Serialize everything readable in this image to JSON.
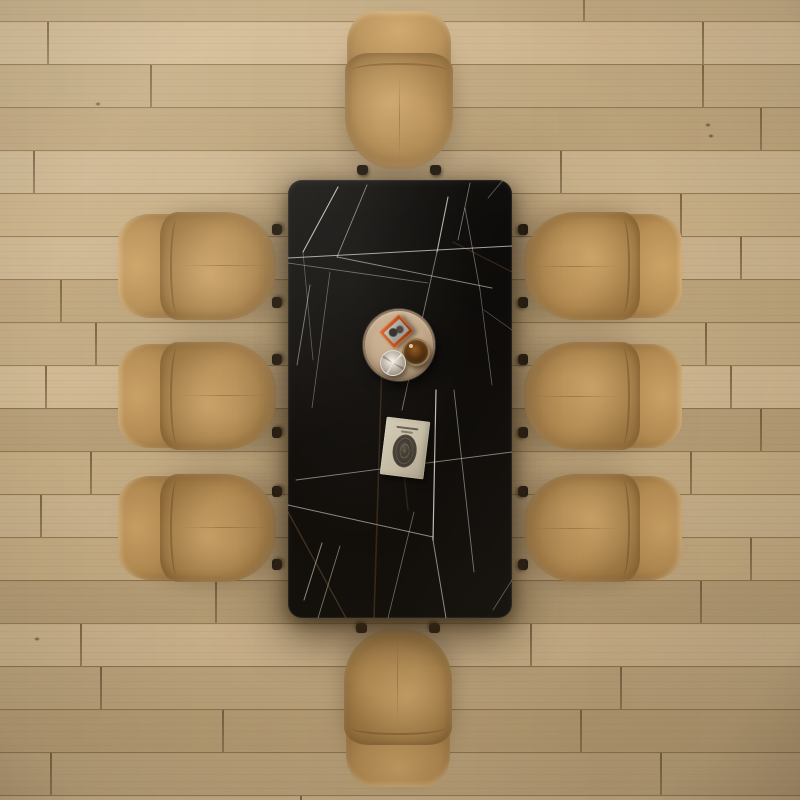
{
  "scene": {
    "colors": {
      "floor_base": "#c7af89",
      "floor_joint": "#6c5434",
      "table_black": "#0d0b09",
      "vein_white": "#e9e5da",
      "vein_gold": "#b98f52",
      "leather": "#b88f55",
      "leather_light": "#cda467",
      "leather_dark": "#96703b",
      "foot": "#221a12",
      "tray": "#c3a98a",
      "tray_rim": "#8a7258",
      "box_orange": "#c4511d",
      "box_gray": "#a4a19a",
      "whiskey": "#33200a",
      "crystal": "#cec8be",
      "book_cover": "#ccc3ad",
      "book_oval": "#38342c"
    },
    "floor": {
      "plank_height": 44,
      "rows": [
        {
          "t": -22,
          "c": 1,
          "j": [
            583
          ]
        },
        {
          "t": 21,
          "c": 0,
          "j": [
            47,
            702
          ]
        },
        {
          "t": 64,
          "c": 1,
          "j": [
            150,
            702
          ]
        },
        {
          "t": 107,
          "c": 2,
          "j": [
            760
          ]
        },
        {
          "t": 150,
          "c": 0,
          "j": [
            33,
            560
          ]
        },
        {
          "t": 193,
          "c": 1,
          "j": [
            680
          ]
        },
        {
          "t": 236,
          "c": 0,
          "j": [
            740
          ]
        },
        {
          "t": 279,
          "c": 2,
          "j": [
            60
          ]
        },
        {
          "t": 322,
          "c": 1,
          "j": [
            95,
            705
          ]
        },
        {
          "t": 365,
          "c": 0,
          "j": [
            45,
            730
          ]
        },
        {
          "t": 408,
          "c": 2,
          "j": [
            760
          ]
        },
        {
          "t": 451,
          "c": 1,
          "j": [
            90,
            690
          ]
        },
        {
          "t": 494,
          "c": 0,
          "j": [
            40
          ]
        },
        {
          "t": 537,
          "c": 1,
          "j": [
            750
          ]
        },
        {
          "t": 580,
          "c": 2,
          "j": [
            215,
            700
          ]
        },
        {
          "t": 623,
          "c": 0,
          "j": [
            80,
            530
          ]
        },
        {
          "t": 666,
          "c": 1,
          "j": [
            100,
            620
          ]
        },
        {
          "t": 709,
          "c": 2,
          "j": [
            222,
            580
          ]
        },
        {
          "t": 752,
          "c": 1,
          "j": [
            50,
            660
          ]
        },
        {
          "t": 795,
          "c": 0,
          "j": [
            300
          ]
        }
      ],
      "knots": [
        [
          705,
          123
        ],
        [
          708,
          134
        ],
        [
          34,
          637
        ],
        [
          420,
          62
        ],
        [
          95,
          102
        ]
      ]
    },
    "table": {
      "x": 288,
      "y": 180,
      "width": 224,
      "height": 438,
      "corner_radius": 14
    },
    "veins": [
      [
        50,
        7,
        15,
        72,
        1.1,
        0.8,
        "w"
      ],
      [
        79,
        5,
        49,
        77,
        0.9,
        0.55,
        "w"
      ],
      [
        15,
        72,
        25,
        180,
        0.8,
        0.35,
        "w"
      ],
      [
        160,
        17,
        149,
        72,
        1.1,
        0.75,
        "w"
      ],
      [
        149,
        72,
        114,
        230,
        0.9,
        0.5,
        "w"
      ],
      [
        182,
        3,
        170,
        60,
        0.8,
        0.5,
        "w"
      ],
      [
        215,
        0,
        200,
        18,
        0.8,
        0.4,
        "w"
      ],
      [
        0,
        78,
        224,
        66,
        1.0,
        0.7,
        "w"
      ],
      [
        0,
        83,
        140,
        103,
        0.8,
        0.45,
        "w"
      ],
      [
        49,
        77,
        204,
        108,
        0.9,
        0.55,
        "w"
      ],
      [
        177,
        28,
        192,
        110,
        0.8,
        0.45,
        "w"
      ],
      [
        192,
        110,
        204,
        205,
        0.8,
        0.4,
        "w"
      ],
      [
        22,
        105,
        9,
        185,
        0.9,
        0.5,
        "w"
      ],
      [
        42,
        92,
        24,
        228,
        0.8,
        0.4,
        "w"
      ],
      [
        148,
        210,
        145,
        360,
        1.2,
        0.85,
        "w"
      ],
      [
        145,
        360,
        158,
        438,
        1.0,
        0.6,
        "w"
      ],
      [
        166,
        210,
        186,
        392,
        0.9,
        0.5,
        "w"
      ],
      [
        0,
        325,
        145,
        357,
        1.0,
        0.6,
        "w"
      ],
      [
        8,
        300,
        224,
        272,
        0.9,
        0.55,
        "w"
      ],
      [
        34,
        363,
        16,
        420,
        1.0,
        0.6,
        "w"
      ],
      [
        52,
        366,
        30,
        438,
        0.9,
        0.5,
        "w"
      ],
      [
        100,
        438,
        126,
        332,
        0.8,
        0.45,
        "w"
      ],
      [
        224,
        150,
        196,
        130,
        0.7,
        0.35,
        "w"
      ],
      [
        205,
        430,
        224,
        400,
        0.8,
        0.4,
        "w"
      ],
      [
        95,
        150,
        86,
        438,
        1.6,
        0.22,
        "g"
      ],
      [
        0,
        332,
        58,
        438,
        1.3,
        0.3,
        "g"
      ],
      [
        224,
        92,
        165,
        62,
        1.2,
        0.22,
        "g"
      ],
      [
        110,
        240,
        120,
        330,
        1.4,
        0.18,
        "g"
      ]
    ],
    "chairs": {
      "count": 8,
      "body_width": 110,
      "body_length": 160,
      "positions": [
        {
          "id": "top",
          "cx": 399,
          "cy": 91,
          "rot": 0
        },
        {
          "id": "bottom",
          "cx": 398,
          "cy": 707,
          "rot": 180
        },
        {
          "id": "left-1",
          "cx": 198,
          "cy": 266,
          "rot": -90
        },
        {
          "id": "left-2",
          "cx": 198,
          "cy": 396,
          "rot": -90
        },
        {
          "id": "left-3",
          "cx": 198,
          "cy": 528,
          "rot": -90
        },
        {
          "id": "right-1",
          "cx": 602,
          "cy": 266,
          "rot": 90
        },
        {
          "id": "right-2",
          "cx": 602,
          "cy": 396,
          "rot": 90
        },
        {
          "id": "right-3",
          "cx": 602,
          "cy": 528,
          "rot": 90
        }
      ]
    },
    "tray": {
      "cx": 399,
      "cy": 345,
      "radius": 36,
      "items": {
        "box": {
          "cx": 33,
          "cy": 22,
          "w": 27,
          "h": 23,
          "rot": -42
        },
        "whiskey": {
          "cx": 51,
          "cy": 41,
          "r": 12
        },
        "crystal": {
          "cx": 29,
          "cy": 53,
          "r": 12
        }
      }
    },
    "book": {
      "x": 383,
      "y": 419,
      "width": 44,
      "height": 58,
      "rot": 7
    }
  }
}
